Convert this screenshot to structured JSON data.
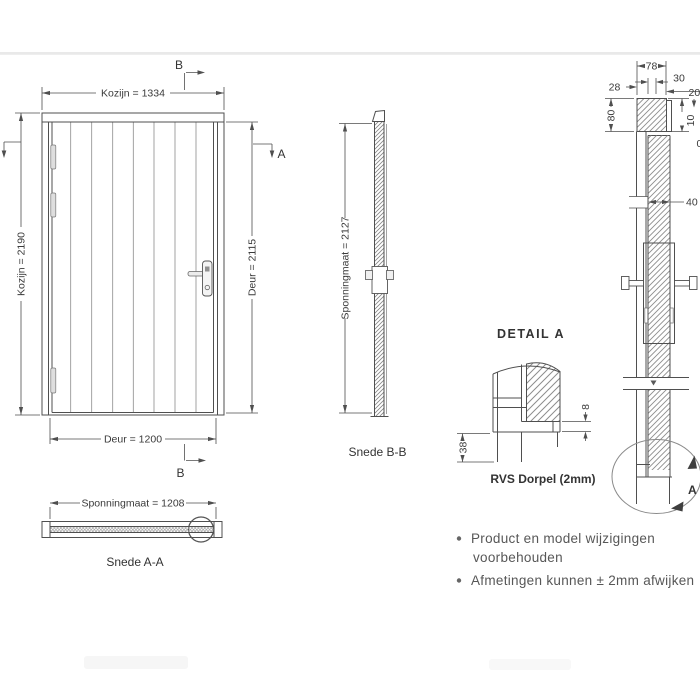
{
  "front": {
    "dim_frame_width": "Kozijn = 1334",
    "dim_frame_height": "Kozijn = 2190",
    "dim_door_height": "Deur = 2115",
    "dim_door_width": "Deur = 1200",
    "marker_b": "B",
    "marker_a": "A"
  },
  "section_aa": {
    "dim": "Sponningmaat = 1208",
    "caption": "Snede A-A"
  },
  "section_bb": {
    "dim": "Sponningmaat = 2127",
    "caption": "Snede B-B"
  },
  "vertical_section": {
    "dim_78": "78",
    "dim_30": "30",
    "dim_28": "28",
    "dim_20": "20",
    "dim_80": "80",
    "dim_10": "10",
    "dim_40": "40",
    "dim_partial": "0",
    "marker_a": "A"
  },
  "detail_a": {
    "title": "DETAIL A",
    "dim_38": "38",
    "dim_8": "8",
    "caption": "RVS Dorpel (2mm)"
  },
  "notes": {
    "line1": "Product en model wijzigingen",
    "line2": "voorbehouden",
    "line3": "Afmetingen kunnen ± 2mm afwijken"
  },
  "colors": {
    "line": "#4f4f4f",
    "text": "#3a3a3a",
    "note_text": "#575757",
    "hatch": "#8d8d8d",
    "band": "#e9e9e9",
    "background": "#ffffff"
  }
}
